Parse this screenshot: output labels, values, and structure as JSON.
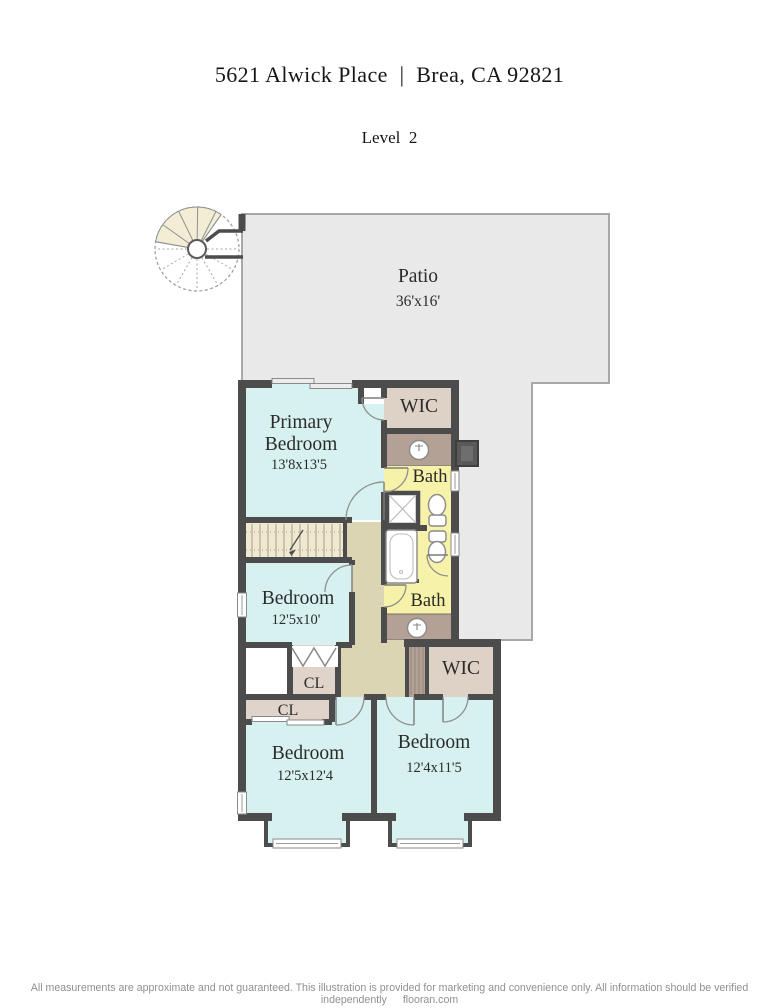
{
  "header": {
    "title": "5621 Alwick Place  |  Brea, CA 92821",
    "level": "Level  2"
  },
  "rooms": {
    "patio": {
      "label": "Patio",
      "dims": "36'x16'"
    },
    "primary_bedroom": {
      "label": "Primary Bedroom",
      "line1": "Primary",
      "line2": "Bedroom",
      "dims": "13'8x13'5"
    },
    "wic_primary": {
      "label": "WIC"
    },
    "bath_primary": {
      "label": "Bath"
    },
    "bath_hall": {
      "label": "Bath"
    },
    "bedroom_middle": {
      "label": "Bedroom",
      "dims": "12'5x10'"
    },
    "closet_middle": {
      "label": "CL"
    },
    "closet_lower": {
      "label": "CL"
    },
    "bedroom_bottom_left": {
      "label": "Bedroom",
      "dims": "12'5x12'4"
    },
    "bedroom_bottom_right": {
      "label": "Bedroom",
      "dims": "12'4x11'5"
    },
    "wic_bottom": {
      "label": "WIC"
    }
  },
  "footer": {
    "disclaimer": "All measurements are approximate and not guaranteed. This illustration is provided for marketing and convenience only. All information should be verified independently",
    "brand": "flooran.com"
  },
  "icons": {
    "spiral_staircase": "spiral-staircase-icon",
    "staircase": "staircase-icon",
    "sink": "sink-icon",
    "toilet": "toilet-icon",
    "bathtub": "bathtub-icon",
    "shower": "shower-icon",
    "fireplace": "fireplace-icon",
    "window": "window-icon",
    "door_swing": "door-swing-icon",
    "bifold_door": "bifold-door-icon",
    "sliding_door": "sliding-door-icon"
  },
  "colors": {
    "wall": "#4c4c4c",
    "room": "#d7f1f0",
    "patio": "#e9e9e9",
    "bath": "#f7f2a9",
    "closet": "#e0d3c9",
    "wic": "#ded2c6",
    "hallway": "#dcd5b4",
    "stairs": "#efe9d2",
    "vanity": "#b3a195",
    "spiral": "#f2edd4",
    "label": "#2b2b2b",
    "footer": "#909090"
  }
}
